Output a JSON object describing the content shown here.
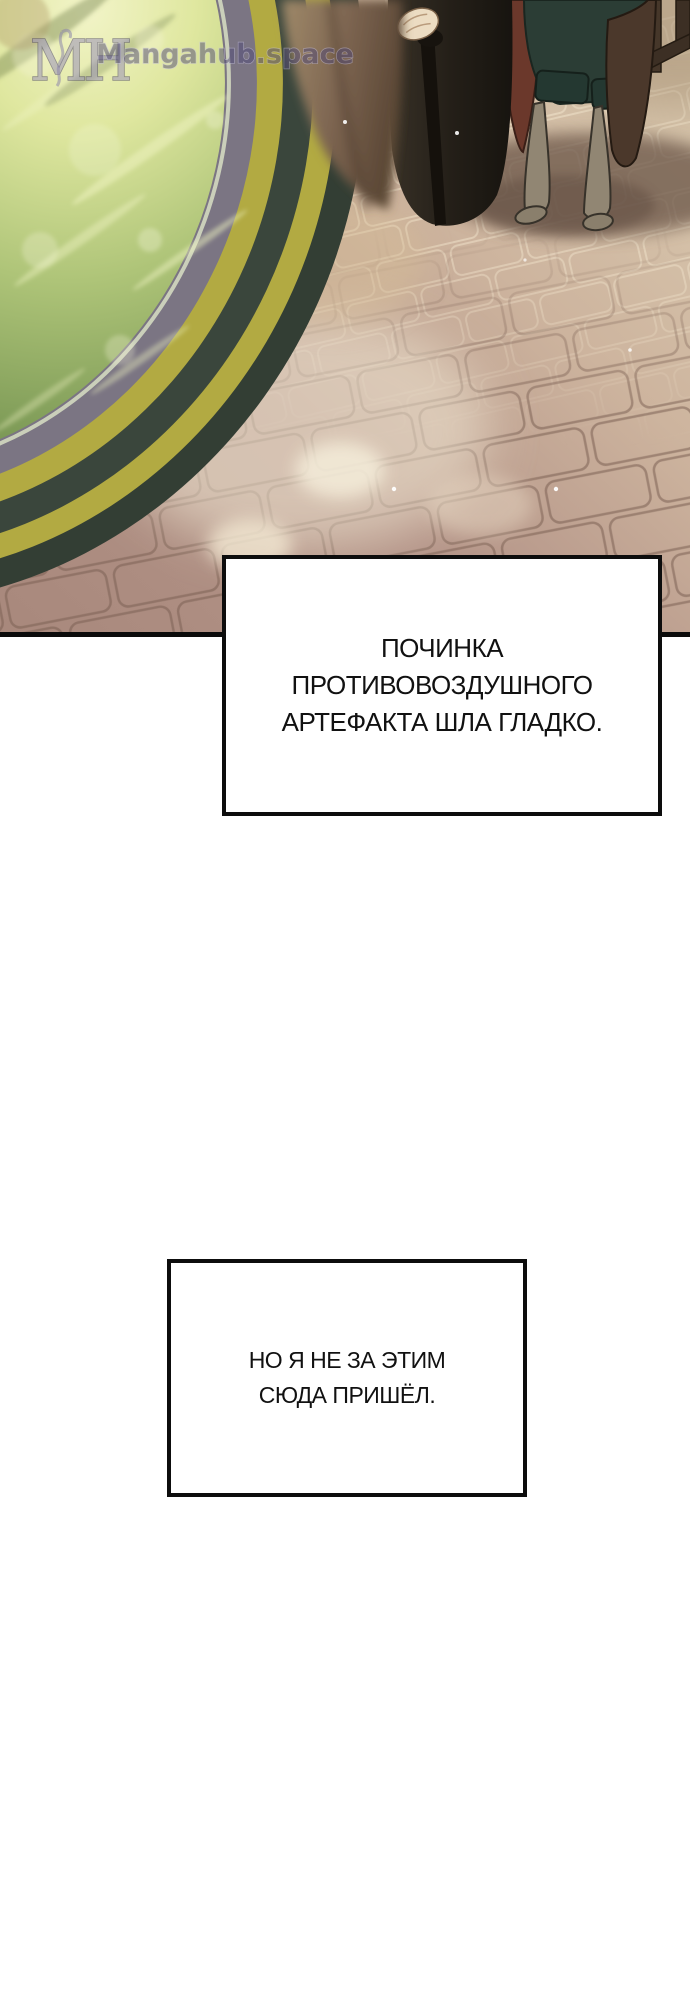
{
  "watermark": {
    "logo": "MH",
    "site": "Mangahub.space"
  },
  "captions": [
    {
      "lines": [
        "ПОЧИНКА",
        "ПРОТИВОВОЗДУШНОГО",
        "АРТЕФАКТА ШЛА ГЛАДКО."
      ]
    },
    {
      "lines": [
        "НО Я НЕ ЗА ЭТИМ",
        "СЮДА ПРИШЁЛ."
      ]
    }
  ],
  "colors": {
    "artifact_green_light": "#f2f4c8",
    "artifact_green_mid": "#aec478",
    "artifact_green_dark": "#4b6339",
    "rim_dark": "#333e34",
    "rim_yellow": "#b2aa42",
    "rim_gray_band": "#7b7583",
    "floor_tan": "#dccdb2",
    "floor_pink": "#a98e83",
    "cape_maroon": "#6b382b",
    "cape_brown": "#4b382b",
    "breeches_teal": "#2b3d35",
    "robe_dark": "#1b1813",
    "shadow_brown": "#715c4e",
    "watermark_purple": "#514a78",
    "panel_border": "#0d0d0d",
    "caption_text": "#111111"
  }
}
